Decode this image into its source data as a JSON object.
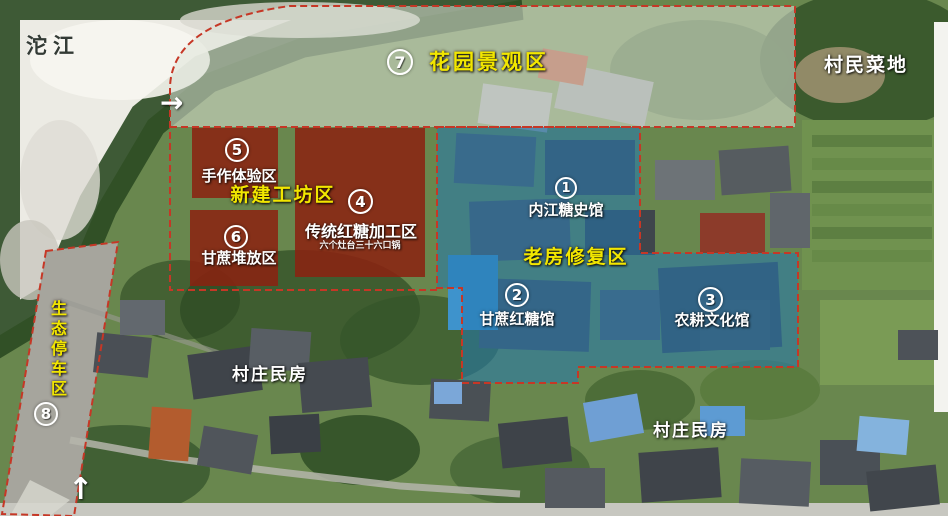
{
  "landmarks": {
    "river": "沱江",
    "vegetable_field": "村民菜地",
    "village_houses": "村庄民房"
  },
  "area_groups": {
    "new_workshop": "新建工坊区",
    "old_house_restoration": "老房修复区"
  },
  "zones": [
    {
      "number": "1",
      "label": "内江糖史馆"
    },
    {
      "number": "2",
      "label": "甘蔗红糖馆"
    },
    {
      "number": "3",
      "label": "农耕文化馆"
    },
    {
      "number": "4",
      "label": "传统红糖加工区",
      "sublabel": "六个灶台三十六口锅"
    },
    {
      "number": "5",
      "label": "手作体验区"
    },
    {
      "number": "6",
      "label": "甘蔗堆放区"
    },
    {
      "number": "7",
      "label": "花园景观区"
    },
    {
      "number": "8",
      "label": "生态停车区"
    }
  ],
  "icons": {
    "flow_arrow_right": "→",
    "flow_arrow_up": "↑"
  },
  "colors": {
    "zone_fill_red": "#8c2110",
    "zone_fill_blue": "#2278b0",
    "garden_overlay": "#dfe3d8",
    "boundary_dash": "#c63726",
    "label_yellow": "#f2e600",
    "label_white": "#ffffff"
  }
}
